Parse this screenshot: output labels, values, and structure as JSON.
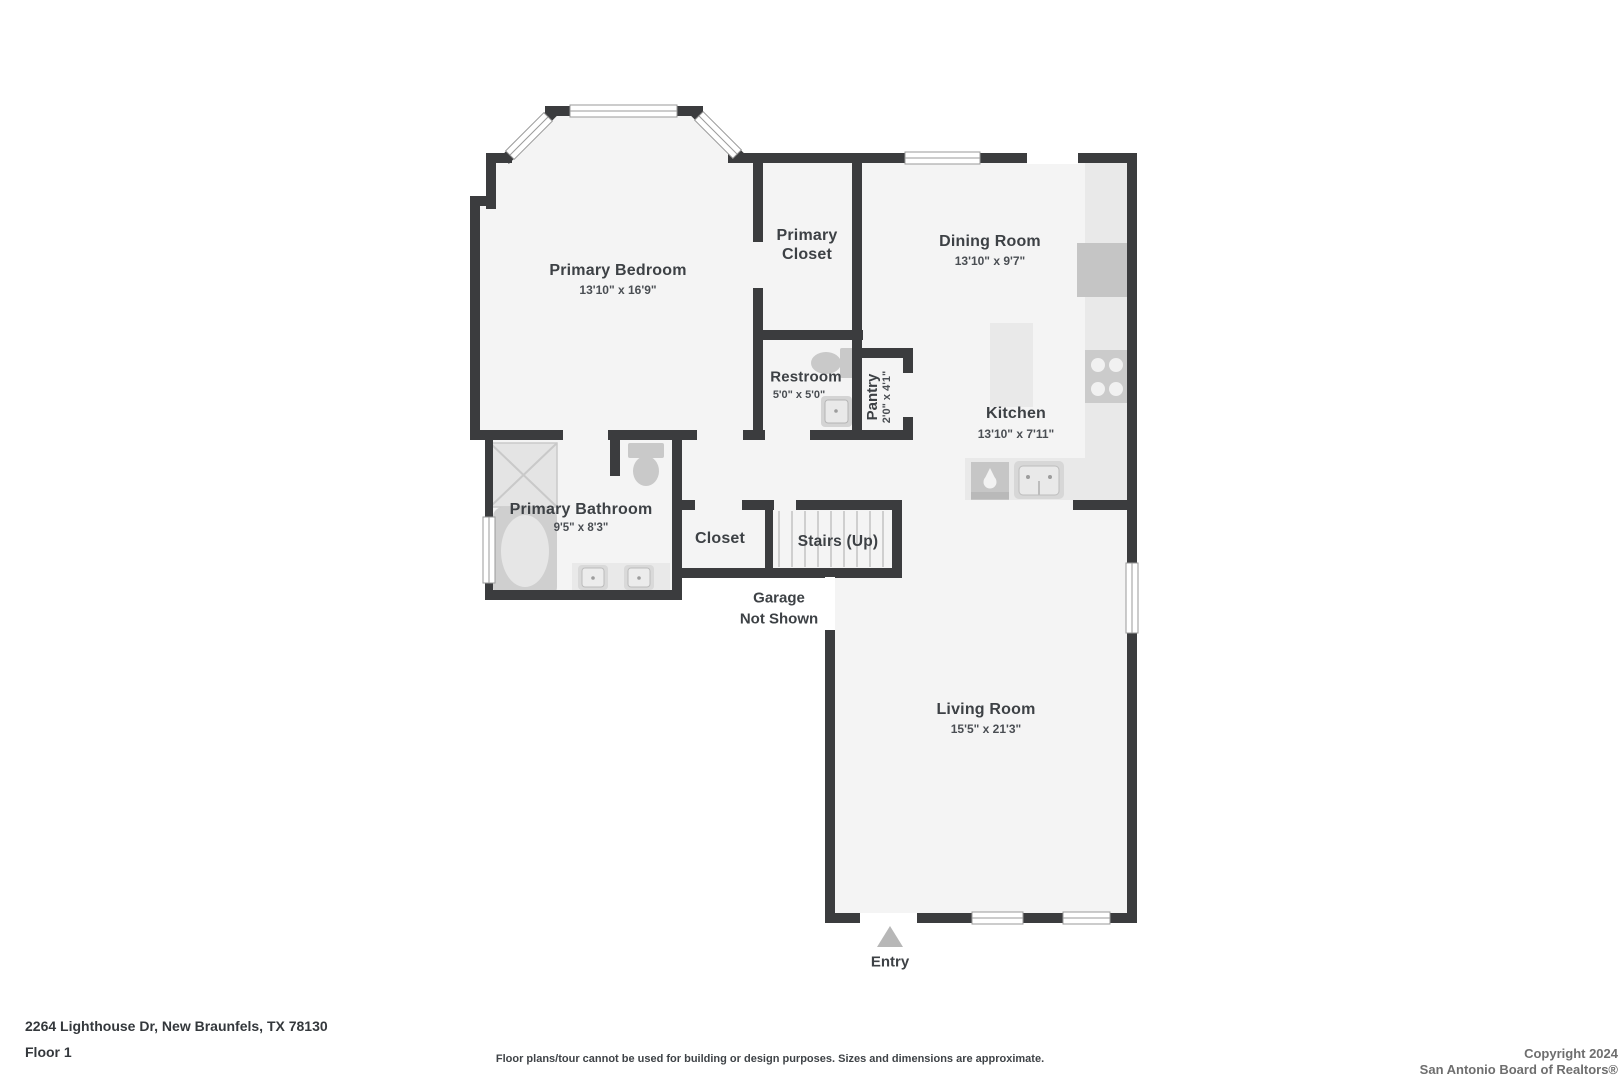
{
  "colors": {
    "wall": "#3b3c3e",
    "floor": "#f4f4f4",
    "counter": "#e9e9e9",
    "appliance": "#c6c6c6",
    "label": "#3d4145"
  },
  "rooms": [
    {
      "id": "primary-bedroom",
      "name": "Primary Bedroom",
      "dims": "13'10\" x 16'9\""
    },
    {
      "id": "primary-closet",
      "name": "Primary Closet",
      "dims": ""
    },
    {
      "id": "dining-room",
      "name": "Dining Room",
      "dims": "13'10\" x 9'7\""
    },
    {
      "id": "restroom",
      "name": "Restroom",
      "dims": "5'0\" x 5'0\""
    },
    {
      "id": "pantry",
      "name": "Pantry",
      "dims": "2'0\" x 4'1\""
    },
    {
      "id": "kitchen",
      "name": "Kitchen",
      "dims": "13'10\" x 7'11\""
    },
    {
      "id": "primary-bathroom",
      "name": "Primary Bathroom",
      "dims": "9'5\" x 8'3\""
    },
    {
      "id": "closet",
      "name": "Closet",
      "dims": ""
    },
    {
      "id": "stairs",
      "name": "Stairs (Up)",
      "dims": ""
    },
    {
      "id": "living-room",
      "name": "Living Room",
      "dims": "15'5\" x 21'3\""
    }
  ],
  "annotations": {
    "garage_line1": "Garage",
    "garage_line2": "Not Shown",
    "entry": "Entry"
  },
  "footer": {
    "address": "2264 Lighthouse Dr, New Braunfels, TX 78130",
    "floor": "Floor 1",
    "disclaimer": "Floor plans/tour cannot be used for building or design purposes. Sizes and dimensions are approximate.",
    "copyright_line1": "Copyright 2024",
    "copyright_line2": "San Antonio Board of Realtors®"
  }
}
